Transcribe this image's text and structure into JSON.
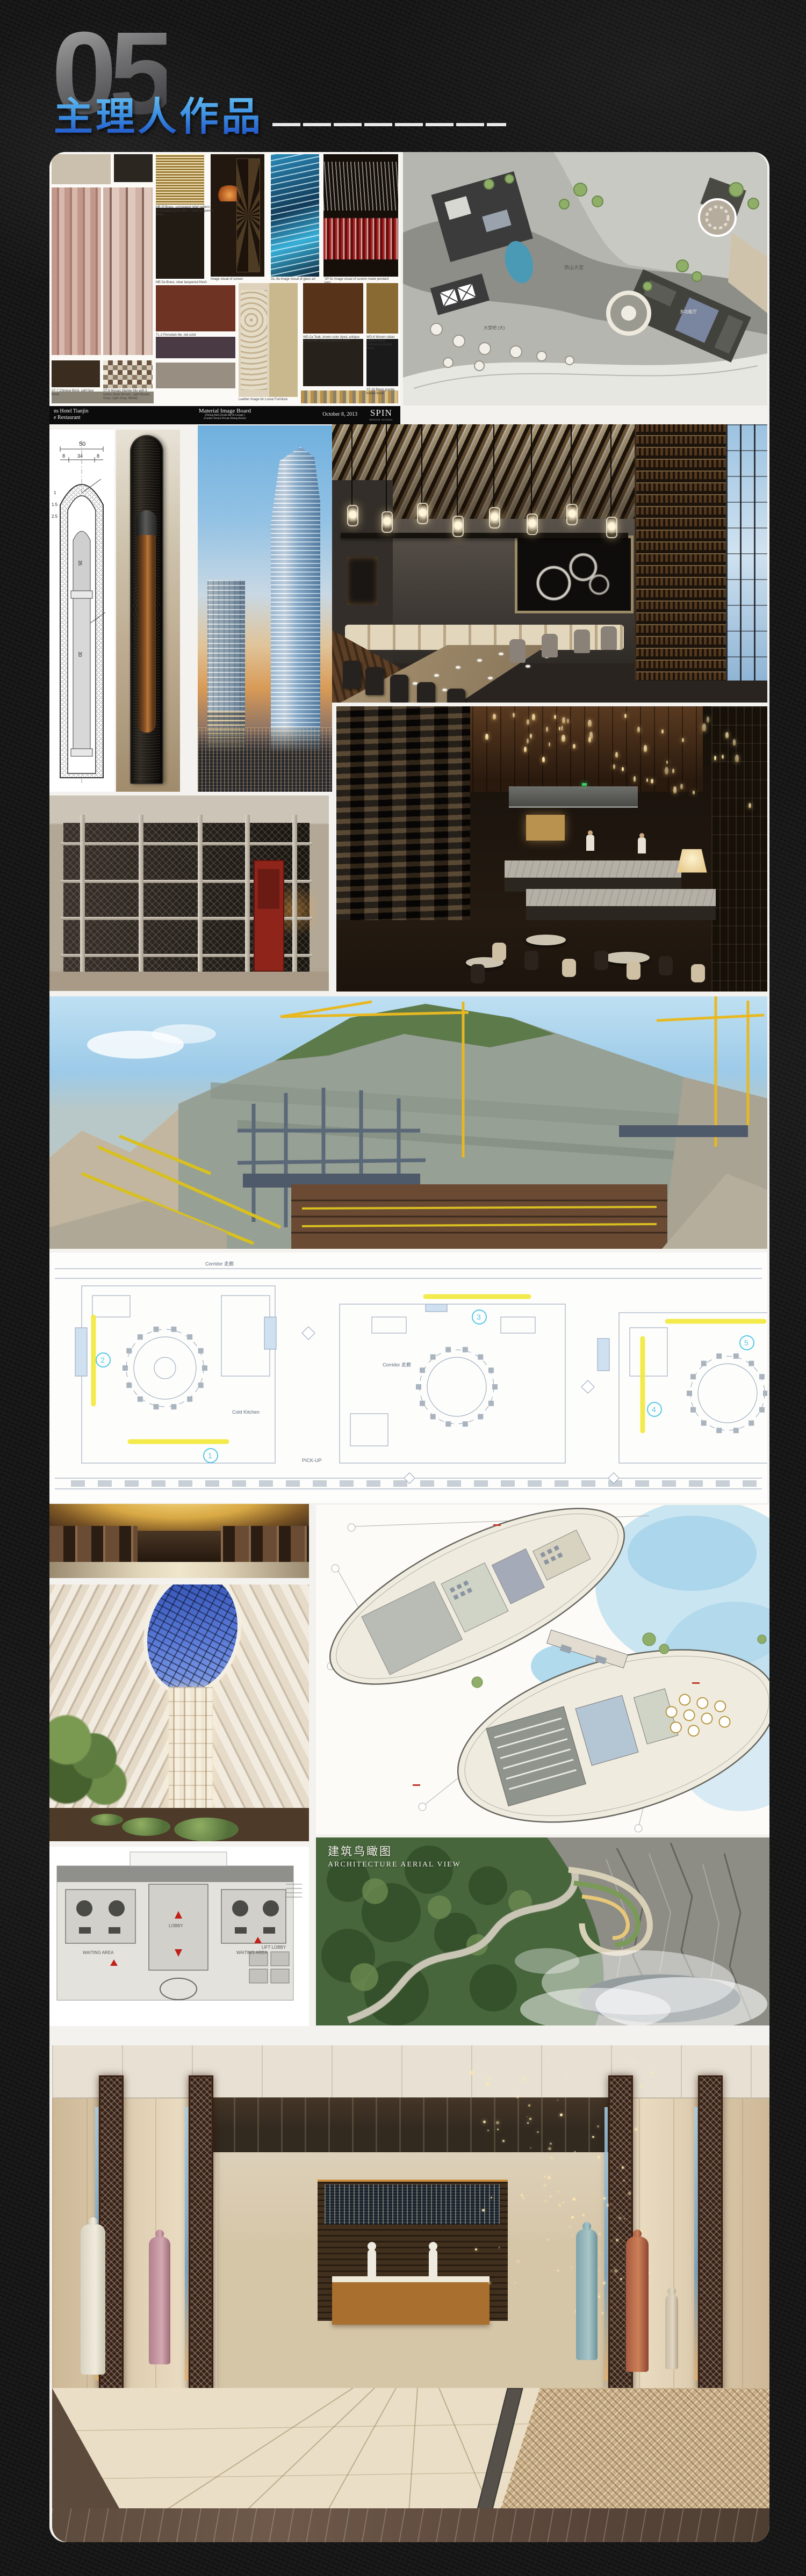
{
  "header": {
    "number": "05",
    "title": "主理人作品"
  },
  "palette": {
    "page_bg": "#181818",
    "title_gradient_top": "#7ad6f8",
    "title_gradient_bottom": "#1a44c2",
    "number_gradient_top": "#a8a8a8",
    "number_gradient_bottom": "#3c3c40",
    "dash_color": "#eaeaea",
    "sheet_white": "#f4f2ee",
    "highlight_yellow": "#f2ea3a",
    "marker_cyan": "#56c8e8",
    "crane_yellow": "#e8b821",
    "pool_blue": "#4a9ab5",
    "sky_blue": "#6fb0de",
    "sunset_orange": "#d89a56",
    "skylight_blue": "#2c4cb0",
    "lobby_cream": "#e5ddcf",
    "lattice_brown": "#3a2013"
  },
  "material_board": {
    "swatch_colors": [
      "#cbbfae",
      "#2b2620",
      "#221b13",
      "#6e3322",
      "#57331a",
      "#8a6a33",
      "#26211a",
      "#1a1a1a",
      "#3a2c1e",
      "#4a3a44",
      "#988f82",
      "#8b8577"
    ],
    "captions": [
      "ME-5f Brass, corrugated relief pattern, champagne gold color + clear lacquered finish",
      "Image visual of screen",
      "GL-9a Image visual of glass art",
      "SP-5c Image visual of custom made pendant light",
      "ME-5a Brass, clear lacquered finish",
      "TL-2 Porcelain tile, red color",
      "WD-2a Teak, brown color dyed, antique processed, clear lacquered finish",
      "WD-6 Woven rattan applied dyed, urethane polished finish",
      "ST-2d Black granite, honed finish",
      "ST-8 Mosaic Marble Mix with 5 colors (Dark Brown, Light Brown, Grey, Light Gray, White)",
      "Leather Image for Loose Furniture",
      "ST-7 Chinese Brick, split face finish",
      "OT-5 Custom made rug",
      "TL-1 Porcelain tile, grey color"
    ],
    "footer": {
      "client_line1": "ns Hotel Tianjin",
      "client_line2": "e Restaurant",
      "title": "Material Image Board",
      "sub1": "(Dining Hall) (Sushi Bar & Lounge )",
      "sub2": "(Garden Terrace Private Dining Room)",
      "date": "October 8, 2013",
      "logo": "SPIN",
      "logo_sub": "DESIGN STUDIO"
    }
  },
  "site_plan": {
    "labels": [
      "西山大堂",
      "大堂吧 (大)",
      "多功能厅"
    ]
  },
  "cad_column": {
    "dims": {
      "total": "50",
      "left": "8",
      "mid": "34",
      "right": "8",
      "inner": "35",
      "shaft": "30",
      "s1": "1",
      "s2": "1.5",
      "s3": "2.5"
    }
  },
  "banquet_plan": {
    "corridor_label_1": "Corridor 走廊",
    "corridor_label_2": "Corridor 走廊",
    "kitchen_label": "Cold Kitchen",
    "pickup_label": "PICK-UP",
    "markers": [
      "1",
      "2",
      "3",
      "4",
      "5"
    ]
  },
  "small_plan": {
    "waiting_left": "WAITING AREA",
    "lobby": "LOBBY",
    "waiting_right": "WAITING AREA",
    "lift": "LIFT LOBBY"
  },
  "aerial": {
    "label_cn": "建筑鸟瞰图",
    "label_en": "ARCHITECTURE AERIAL VIEW"
  }
}
